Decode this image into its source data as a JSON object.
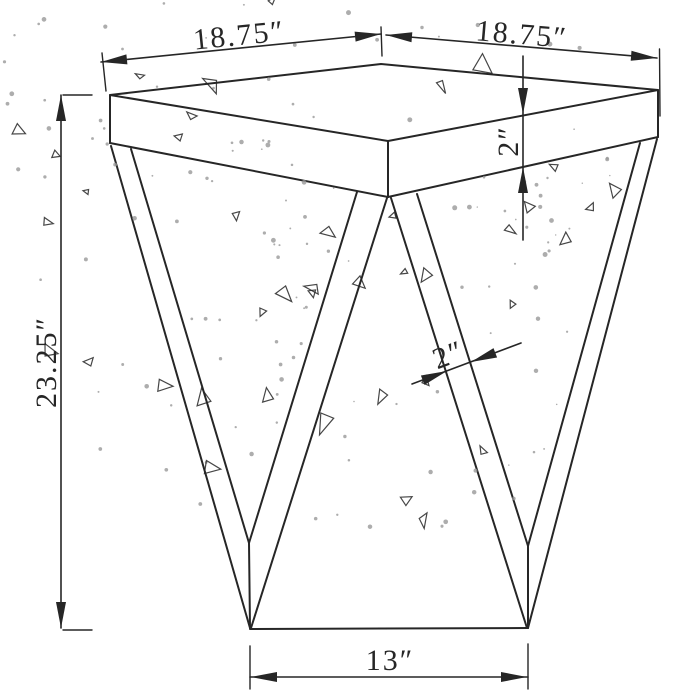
{
  "dimensions": {
    "top_left_width": {
      "label": "18.75″",
      "value_inches": 18.75
    },
    "top_right_width": {
      "label": "18.75″",
      "value_inches": 18.75
    },
    "top_thickness": {
      "label": "2″",
      "value_inches": 2
    },
    "overall_height": {
      "label": "23.25″",
      "value_inches": 23.25
    },
    "leg_strut_thickness": {
      "label": "2″",
      "value_inches": 2
    },
    "base_width": {
      "label": "13″",
      "value_inches": 13
    }
  },
  "colors": {
    "line": "#262626",
    "background": "#ffffff",
    "speckle_dot": "#999999"
  },
  "texture": {
    "style": "speckled crystal-inlay leg panels (dots and small open triangles)",
    "triangles_per_panel": 26,
    "dots_per_panel": 92,
    "seed": 7
  }
}
